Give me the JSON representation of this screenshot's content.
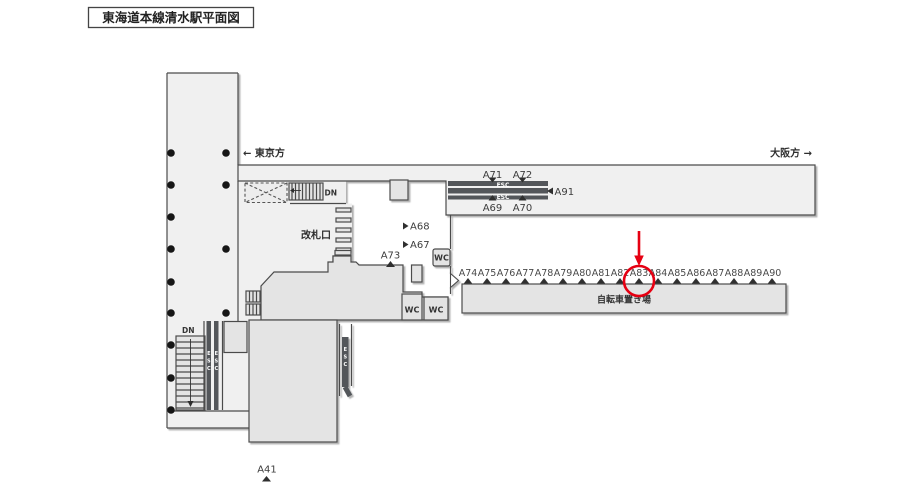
{
  "title": "東海道本線清水駅平面図",
  "directions": {
    "tokyo": "←  東京方",
    "osaka": "大阪方  →"
  },
  "labels": {
    "gate": "改札口",
    "bicycle_parking": "自転車置き場",
    "down": "DN",
    "escalator": "ESC",
    "toilet": "WC"
  },
  "ad_spots": {
    "escalator_upper": [
      "A71",
      "A72"
    ],
    "escalator_lower": [
      "A69",
      "A70"
    ],
    "escalator_end": "A91",
    "concourse_right": [
      "A68",
      "A67"
    ],
    "concourse_gate": "A73",
    "bicycle_row": [
      "A74",
      "A75",
      "A76",
      "A77",
      "A78",
      "A79",
      "A80",
      "A81",
      "A82",
      "A83",
      "A84",
      "A85",
      "A86",
      "A87",
      "A88",
      "A89",
      "A90"
    ],
    "south_exit": "A41",
    "highlighted": "A83"
  },
  "colors": {
    "highlight": "#e60012",
    "walkway": "#f0f0f0",
    "structure": "#e4e4e4",
    "escalator_band": "#53575a",
    "outline": "#4b4b4b"
  }
}
